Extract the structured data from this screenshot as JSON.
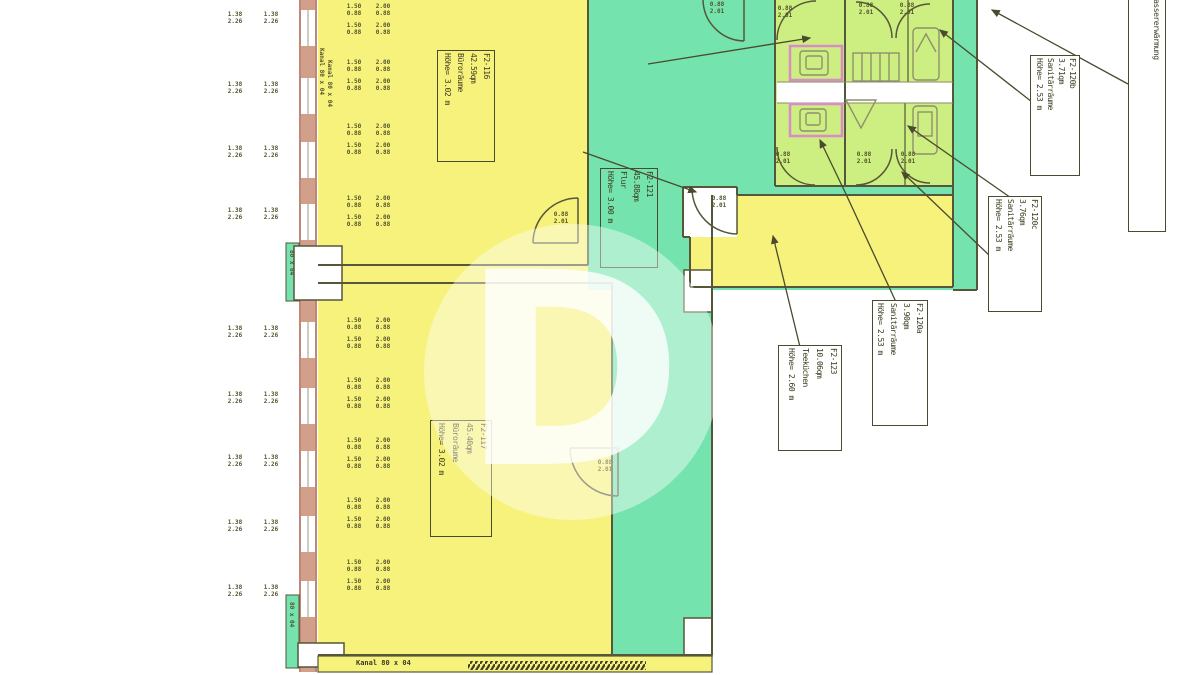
{
  "plan": {
    "rooms": {
      "r116": {
        "lines": [
          "F2-116",
          "42.59qm",
          "Büroräume",
          "Höhe= 3.02 m"
        ]
      },
      "r117": {
        "lines": [
          "F2-117",
          "45.40qm",
          "Büroräume",
          "Höhe= 3.02 m"
        ]
      },
      "r121": {
        "lines": [
          "F2-121",
          "45.88qm",
          "Flur",
          "Höhe= 3.00 m"
        ]
      },
      "r123": {
        "lines": [
          "F2-123",
          "10.06qm",
          "Teeküchen",
          "Höhe= 2.60 m"
        ]
      },
      "r120a": {
        "lines": [
          "F2-120a",
          "3.90qm",
          "Sanitärräume",
          "Höhe= 2.53 m"
        ]
      },
      "r120b": {
        "lines": [
          "F2-120b",
          "3.71qm",
          "Sanitärräume",
          "Höhe= 2.53 m"
        ]
      },
      "r120c": {
        "lines": [
          "F2-120c",
          "3.76qm",
          "Sanitärräume",
          "Höhe= 2.53 m"
        ]
      },
      "cut": {
        "lines": [
          "- und Brauchwassererwärmung",
          "60 m"
        ]
      }
    },
    "tags": {
      "window": {
        "l1": "1.38",
        "l2": "2.26"
      },
      "unitA": {
        "l1": "1.50",
        "l2": "0.88"
      },
      "unitB": {
        "l1": "2.00",
        "l2": "0.88"
      },
      "door": {
        "l1": "0.88",
        "l2": "2.01"
      }
    },
    "notes": {
      "wall_left": "Kanal 80 x 04",
      "wall_left2": "Kanal 80 x 04",
      "wall_bottom": "Kanal 80 x 04",
      "strip1": "80 x 04",
      "strip2": "80 x 04"
    },
    "watermark": "D",
    "colors": {
      "office": "#f6f27c",
      "corridor": "#74e3ad",
      "sanitary": "#cdee80",
      "wall": "#56563a",
      "outer_wall": "#a8604c",
      "partition_pink": "#da8cc8"
    }
  }
}
